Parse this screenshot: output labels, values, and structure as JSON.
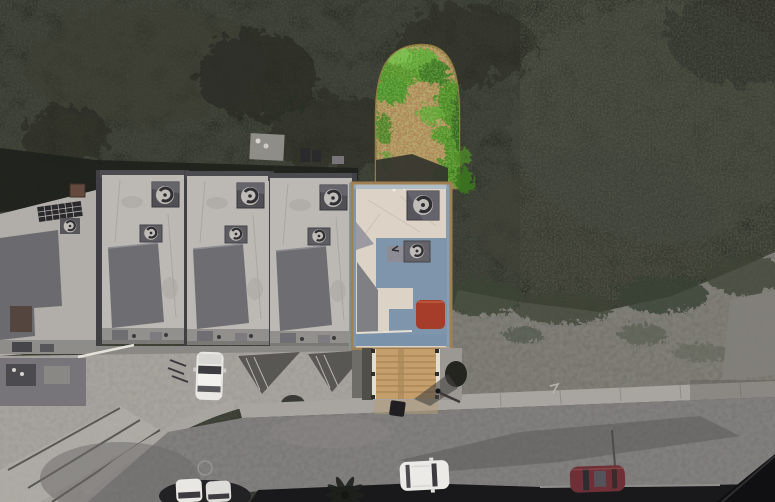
{
  "scene": {
    "type": "aerial-drone-photograph",
    "description": "Top-down drone photo of a townhouse block. One property is highlighted in full colour - an arch-shaped green backyard with tan dirt, a cream flat-roof house with a slate-blue roof section and a red rooftop skylight, and a tan wooden driveway - while the surrounding tree canopy, neighbouring townhouses, street and parked cars are desaturated grey.",
    "palette": {
      "canopy": "#30332b",
      "canopy_mid": "#3c4035",
      "canopy_light": "#4b4f42",
      "scrub": "#76756e",
      "asphalt": "#7b7977",
      "sidewalk": "#a8a5a0",
      "concrete": "#a09d98",
      "roof_light": "#bcb9b4",
      "roof_dark": "#6e6d72",
      "wall_dark": "#403f43",
      "shadow_band": "#20221c",
      "yard_dirt": "#b98f61",
      "yard_border": "#8f7c42",
      "foliage": "#55912c",
      "foliage_dark": "#3c7520",
      "house_cream": "#dcd3c6",
      "house_blue": "#7e95ab",
      "house_red": "#a63d2a",
      "house_trim": "#7d97ad",
      "house_outline": "#a08050",
      "driveway_wood": "#c49e6b",
      "driveway_frame": "#e3ddd0",
      "car_white": "#e8e7e3",
      "car_maroon": "#6e3036",
      "car_window": "#3b3b40",
      "roof_black": "#19191b"
    },
    "objects": [
      {
        "name": "tree-canopy",
        "note": "dense desaturated canopy covering the upper half"
      },
      {
        "name": "arched-backyard",
        "note": "colour-highlighted yard with green foliage ring and tan dirt"
      },
      {
        "name": "highlighted-house",
        "note": "cream flat roof, slate-blue section, red skylight, two AC fan units"
      },
      {
        "name": "wood-driveway",
        "note": "tan plank driveway with white side rails"
      },
      {
        "name": "townhouse-row",
        "note": "four grey flat-roof units plus end unit with solar panel and chimney"
      },
      {
        "name": "street",
        "note": "curving asphalt road with sidewalk"
      },
      {
        "name": "scrubland",
        "note": "grey-green brush east of the house"
      },
      {
        "name": "white-car-driveway",
        "note": "white car parked nose-in at townhouse driveway"
      },
      {
        "name": "white-cars-bottom-left",
        "note": "two white cars at bottom edge"
      },
      {
        "name": "white-suv",
        "note": "white SUV parked on lower street"
      },
      {
        "name": "maroon-car",
        "note": "dark red car parked bottom right"
      },
      {
        "name": "pedestrian",
        "note": "person with long shadow near highlighted driveway"
      },
      {
        "name": "trash-bin",
        "note": "dark bin on the street"
      },
      {
        "name": "palm-tree",
        "note": "dark fronds at bottom centre"
      },
      {
        "name": "dark-rooftops",
        "note": "black roof strip along bottom edge"
      }
    ]
  }
}
